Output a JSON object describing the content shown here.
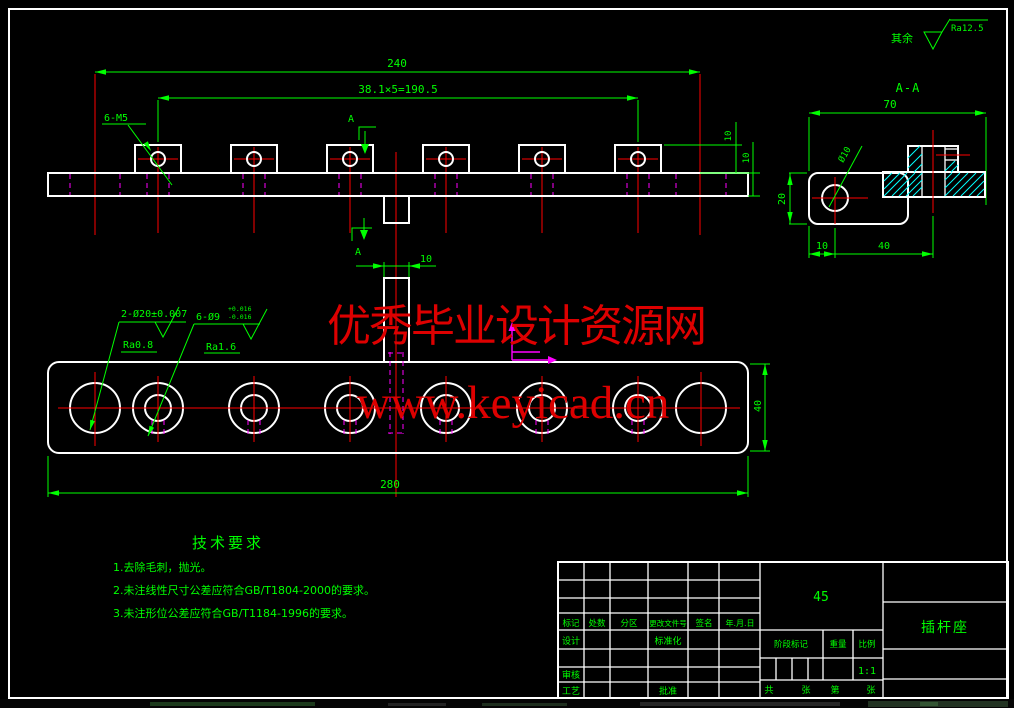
{
  "watermark": {
    "line1": "优秀毕业设计资源网",
    "line2": "www.keyicad.cn",
    "color": "#dd0000"
  },
  "general_roughness": {
    "label": "其余",
    "value": "Ra12.5"
  },
  "front_view": {
    "dim_overall": "240",
    "dim_pitch": "38.1×5=190.5",
    "thread_label": "6-M5",
    "dim_tab_height": "10",
    "dim_bar_height": "10",
    "section_letter_top": "A",
    "section_letter_bottom": "A"
  },
  "section_view": {
    "title": "A-A",
    "dim_width": "70",
    "dim_height": "20",
    "dim_left": "10",
    "dim_boss": "40",
    "hole_label": "Ø10"
  },
  "plan_view": {
    "dim_overall": "280",
    "dim_height": "40",
    "dim_tab": "10",
    "label_dowel": "2-Ø20±0.007",
    "label_dowel_ra": "Ra0.8",
    "label_cbore": "6-Ø9",
    "label_cbore_tol_up": "+0.016",
    "label_cbore_tol_dn": "-0.016",
    "label_cbore_ra": "Ra1.6"
  },
  "tech_req": {
    "title": "技术要求",
    "items": [
      "1.去除毛刺，抛光。",
      "2.未注线性尺寸公差应符合GB/T1804-2000的要求。",
      "3.未注形位公差应符合GB/T1184-1996的要求。"
    ]
  },
  "title_block": {
    "material": "45",
    "part_name": "插杆座",
    "scale_value": "1:1",
    "revision_headers": [
      "标记",
      "处数",
      "分区",
      "更改文件号",
      "签名",
      "年.月.日"
    ],
    "row_design": "设计",
    "row_standard": "标准化",
    "row_audit": "审核",
    "row_process": "工艺",
    "row_approve": "批准",
    "stage_label": "阶段标记",
    "weight_label": "重量",
    "scale_label": "比例",
    "sheet_total": "共",
    "sheet_unit1": "张",
    "sheet_no": "第",
    "sheet_unit2": "张"
  },
  "colors": {
    "dims": "#00ff00",
    "lines": "#ffffff",
    "center": "#ff0000",
    "hidden": "#ff00ff",
    "hatch": "#00ffff"
  }
}
